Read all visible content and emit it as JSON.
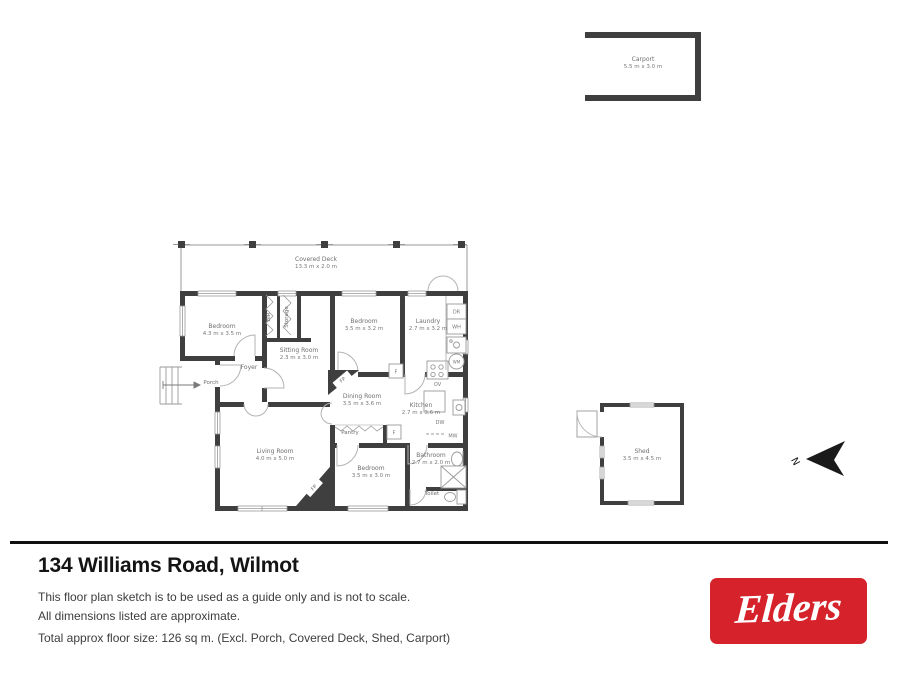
{
  "plan": {
    "rooms": {
      "covered_deck": {
        "name": "Covered Deck",
        "dims": "13.3 m x 2.0 m"
      },
      "bedroom_1": {
        "name": "Bedroom",
        "dims": "4.3 m x 3.5 m"
      },
      "bir": {
        "name": "BIR"
      },
      "storage": {
        "name": "Storage"
      },
      "sitting_room": {
        "name": "Sitting Room",
        "dims": "2.3 m x 3.0 m"
      },
      "bedroom_2": {
        "name": "Bedroom",
        "dims": "3.5 m x 3.2 m"
      },
      "laundry": {
        "name": "Laundry",
        "dims": "2.7 m x 3.2 m"
      },
      "porch": {
        "name": "Porch"
      },
      "foyer": {
        "name": "Foyer"
      },
      "dining_room": {
        "name": "Dining Room",
        "dims": "3.5 m x 3.6 m"
      },
      "kitchen": {
        "name": "Kitchen",
        "dims": "2.7 m x 3.6 m"
      },
      "pantry": {
        "name": "Pantry"
      },
      "living_room": {
        "name": "Living Room",
        "dims": "4.0 m x 5.0 m"
      },
      "bedroom_3": {
        "name": "Bedroom",
        "dims": "3.5 m x 3.0 m"
      },
      "bathroom": {
        "name": "Bathroom",
        "dims": "2.7 m x 2.0 m"
      },
      "toilet": {
        "name": "Toilet"
      },
      "shed": {
        "name": "Shed",
        "dims": "3.5 m x 4.5 m"
      },
      "carport": {
        "name": "Carport",
        "dims": "5.5 m x 3.0 m"
      }
    },
    "labels": {
      "fp": "FP",
      "f": "F",
      "ov": "OV",
      "dw": "DW",
      "mw": "MW",
      "dr": "DR",
      "wh": "WH",
      "wm": "WM",
      "north": "N"
    }
  },
  "footer": {
    "address": "134 Williams Road, Wilmot",
    "disclaimer_line1": "This floor plan sketch is to be used as a guide only and is not to scale.",
    "disclaimer_line2": "All dimensions listed are approximate.",
    "total": "Total approx floor size: 126 sq m. (Excl. Porch, Covered Deck, Shed, Carport)",
    "logo_text": "Elders",
    "brand_color": "#d6232b"
  }
}
